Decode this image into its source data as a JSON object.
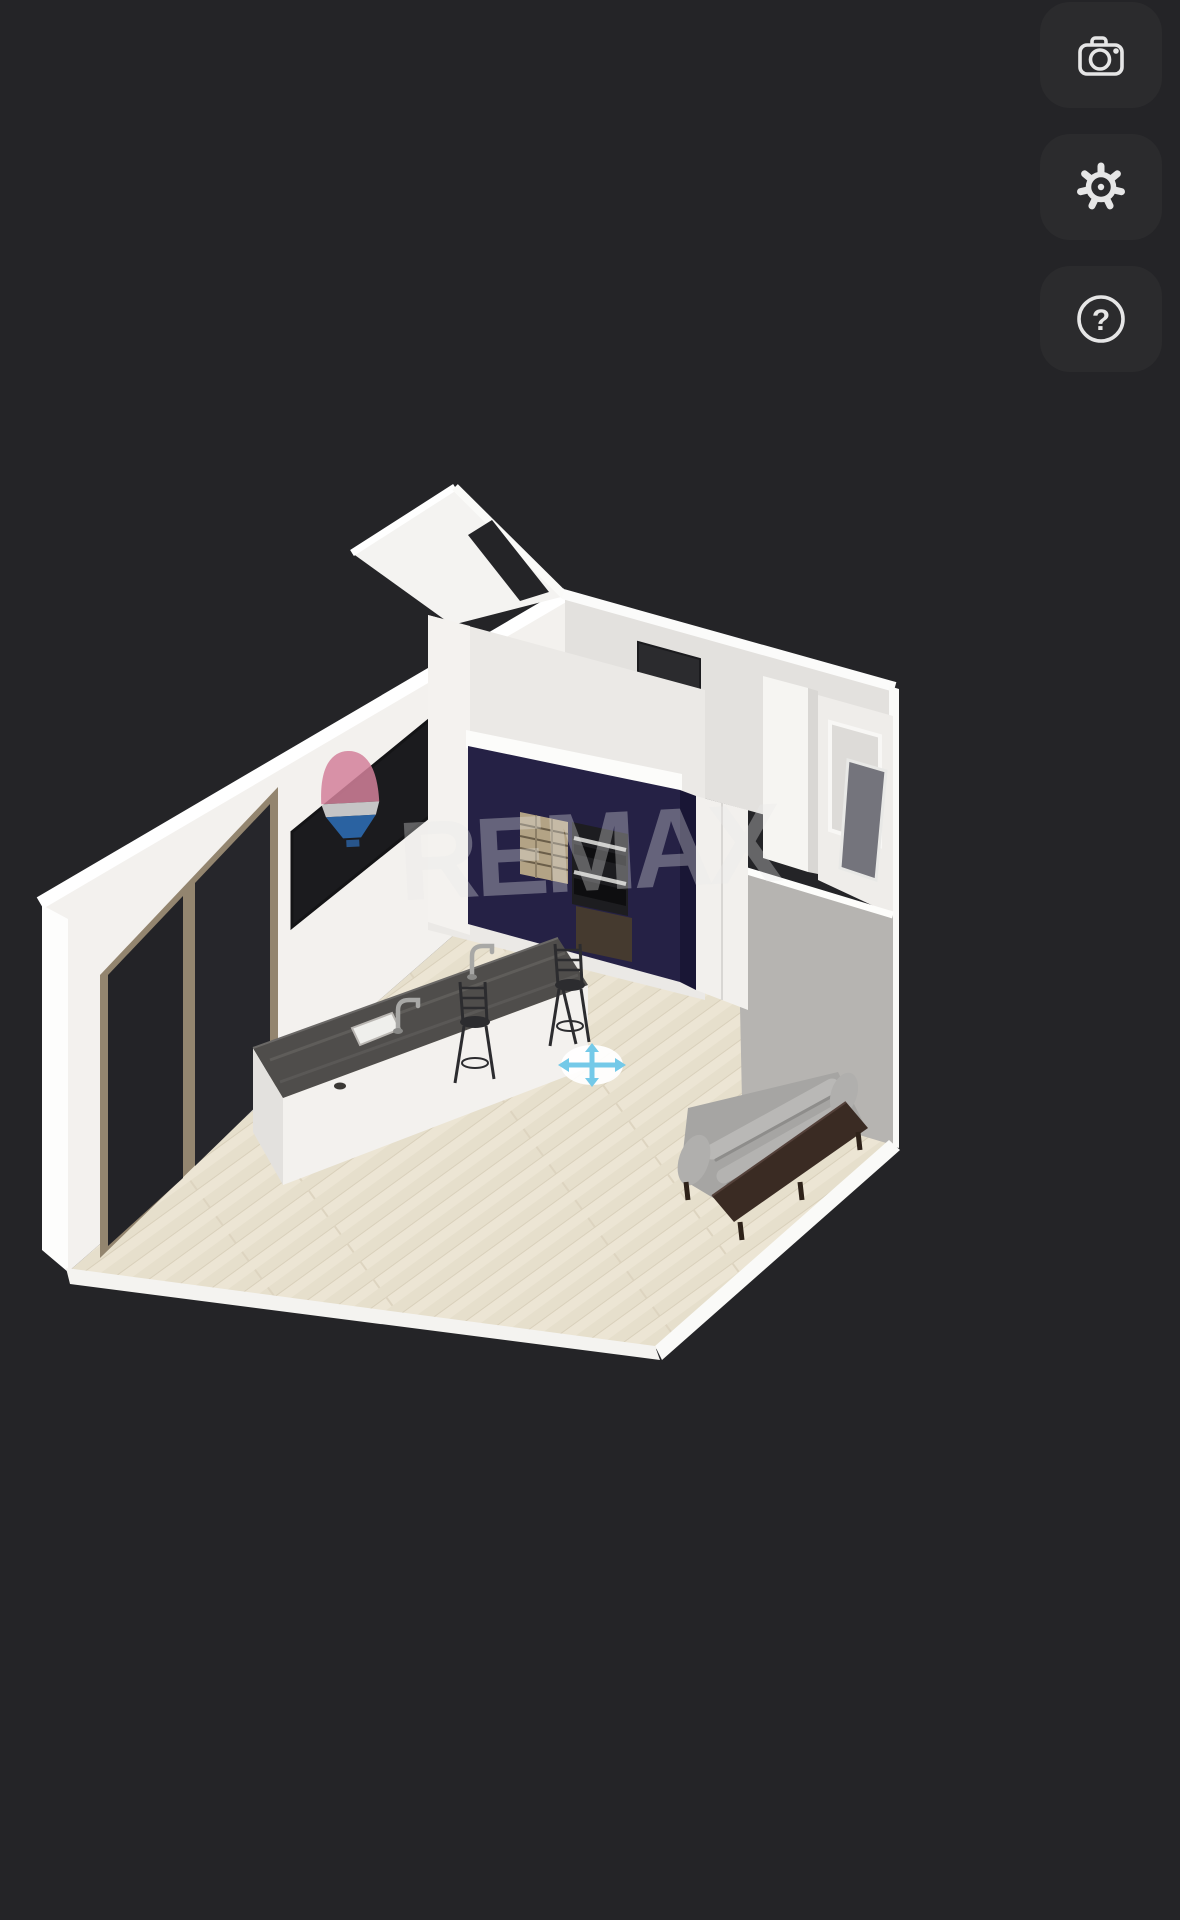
{
  "app": {
    "type": "3d-floorplan-viewer",
    "background_color": "#242427"
  },
  "toolbar": {
    "help_glyph": "?",
    "buttons": [
      {
        "id": "camera",
        "icon": "camera-icon",
        "action": "screenshot"
      },
      {
        "id": "settings",
        "icon": "gear-icon",
        "action": "settings"
      },
      {
        "id": "help",
        "icon": "question-icon",
        "action": "help"
      }
    ]
  },
  "watermark": {
    "text": "REMAX",
    "text_color": "rgba(234,234,234,0.33)",
    "balloon": {
      "top_color": "rgba(210,128,154,0.85)",
      "band_color": "rgba(240,240,240,0.8)",
      "bottom_color": "rgba(45,110,185,0.85)"
    }
  },
  "scene": {
    "view": "isometric-3d-room",
    "floor_color": "#e9e2d1",
    "wall_color": "#f3f1ee",
    "shadow_wall_color": "#b6b4b1",
    "cabinet_color": "#252145",
    "island_top_color": "#4f4d4b",
    "move_tool_color": "#74c9e8",
    "furniture": [
      "kitchen-island",
      "sink",
      "faucet",
      "faucet",
      "bar-stool",
      "bar-stool",
      "tall-navy-cabinet",
      "double-oven",
      "wine-rack",
      "refrigerator",
      "sofa",
      "sliding-glass-door",
      "window",
      "interior-door",
      "hallway",
      "mirror"
    ]
  }
}
